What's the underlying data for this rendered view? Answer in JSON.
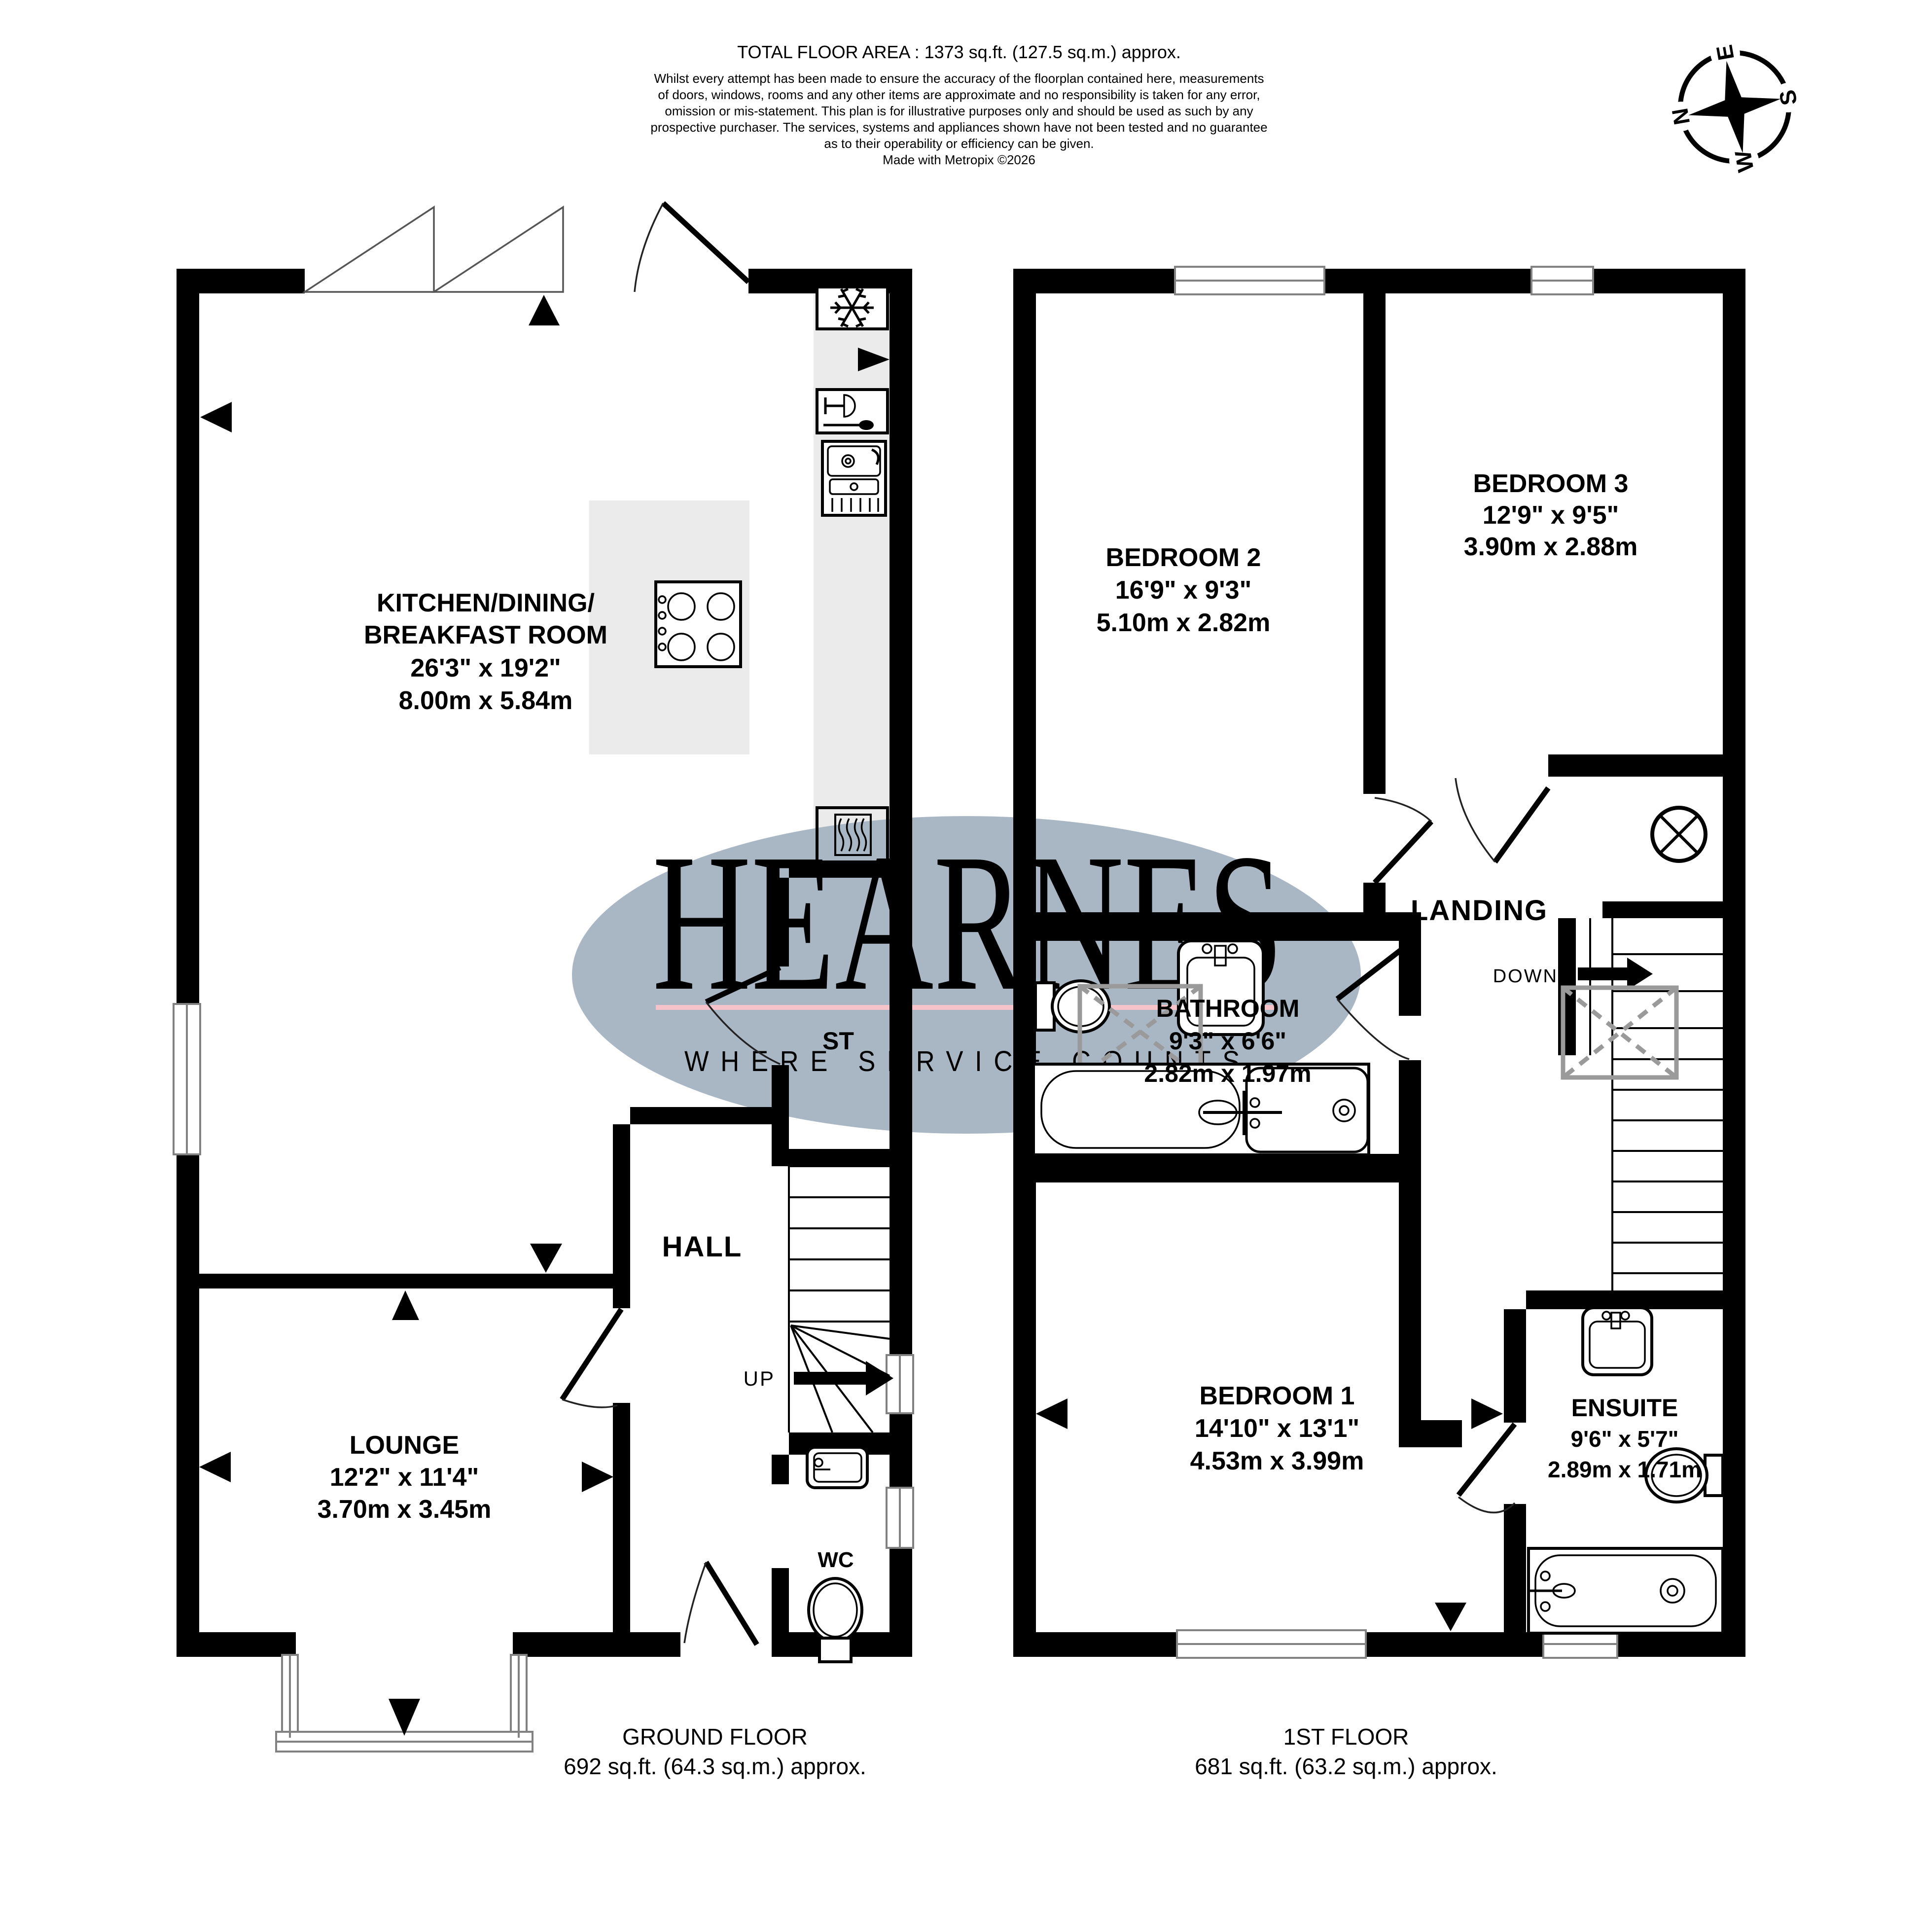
{
  "header": {
    "total_area": "TOTAL FLOOR AREA : 1373 sq.ft. (127.5 sq.m.) approx.",
    "disclaimer": [
      "Whilst every attempt has been made to ensure the accuracy of the floorplan contained here, measurements",
      "of doors, windows, rooms and any other items are approximate and no responsibility is taken for any error,",
      "omission or mis-statement. This plan is for illustrative purposes only and should be used as such by any",
      "prospective purchaser. The services, systems and appliances shown have not been tested and no guarantee",
      "as to their operability or efficiency can be given."
    ],
    "made_with": "Made with Metropix ©2026"
  },
  "compass": {
    "n": "N",
    "e": "E",
    "s": "S",
    "w": "W"
  },
  "watermark": {
    "name": "HEARNES",
    "tagline": "WHERE SERVICE COUNTS",
    "ellipse_color": "#a9b7c5",
    "name_color": "#f5e795",
    "underline_color": "#f6c3cb",
    "tagline_color": "#ffffff"
  },
  "ground_floor": {
    "title": "GROUND FLOOR",
    "area": "692 sq.ft. (64.3 sq.m.) approx.",
    "kitchen": {
      "name_line1": "KITCHEN/DINING/",
      "name_line2": "BREAKFAST ROOM",
      "imperial": "26'3\"  x 19'2\"",
      "metric": "8.00m  x 5.84m"
    },
    "lounge": {
      "name": "LOUNGE",
      "imperial": "12'2\"  x 11'4\"",
      "metric": "3.70m  x 3.45m"
    },
    "hall": "HALL",
    "store": "ST",
    "wc": "WC",
    "up": "UP"
  },
  "first_floor": {
    "title": "1ST FLOOR",
    "area": "681 sq.ft. (63.2 sq.m.) approx.",
    "bedroom1": {
      "name": "BEDROOM 1",
      "imperial": "14'10\"  x 13'1\"",
      "metric": "4.53m  x 3.99m"
    },
    "bedroom2": {
      "name": "BEDROOM 2",
      "imperial": "16'9\"  x 9'3\"",
      "metric": "5.10m  x 2.82m"
    },
    "bedroom3": {
      "name": "BEDROOM 3",
      "imperial": "12'9\"  x 9'5\"",
      "metric": "3.90m  x 2.88m"
    },
    "bathroom": {
      "name": "BATHROOM",
      "imperial": "9'3\"  x 6'6\"",
      "metric": "2.82m  x 1.97m"
    },
    "ensuite": {
      "name": "ENSUITE",
      "imperial": "9'6\"  x 5'7\"",
      "metric": "2.89m  x 1.71m"
    },
    "landing": "LANDING",
    "down": "DOWN"
  }
}
